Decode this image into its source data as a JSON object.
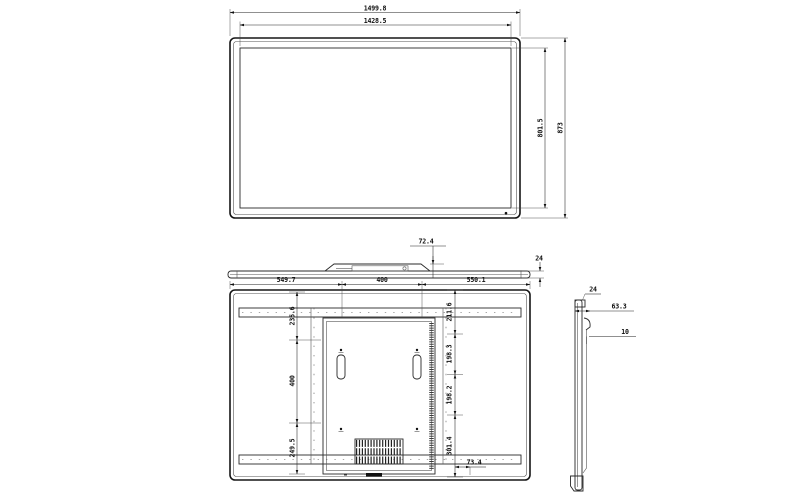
{
  "drawing": {
    "front_view": {
      "width_outer": "1499.8",
      "width_active": "1428.5",
      "height_active": "801.5",
      "height_outer": "873"
    },
    "top_view": {
      "mount_height": "72.4",
      "thickness": "24"
    },
    "back_view": {
      "top_widths": [
        "549.7",
        "400",
        "550.1"
      ],
      "left_heights": [
        "235.6",
        "400",
        "249.5"
      ],
      "right_heights": [
        "211.6",
        "198.3",
        "198.2",
        "301.4"
      ],
      "bottom_offset": "73.4"
    },
    "side_view": {
      "thickness": "24",
      "depth": "63.3",
      "step": "10"
    }
  }
}
